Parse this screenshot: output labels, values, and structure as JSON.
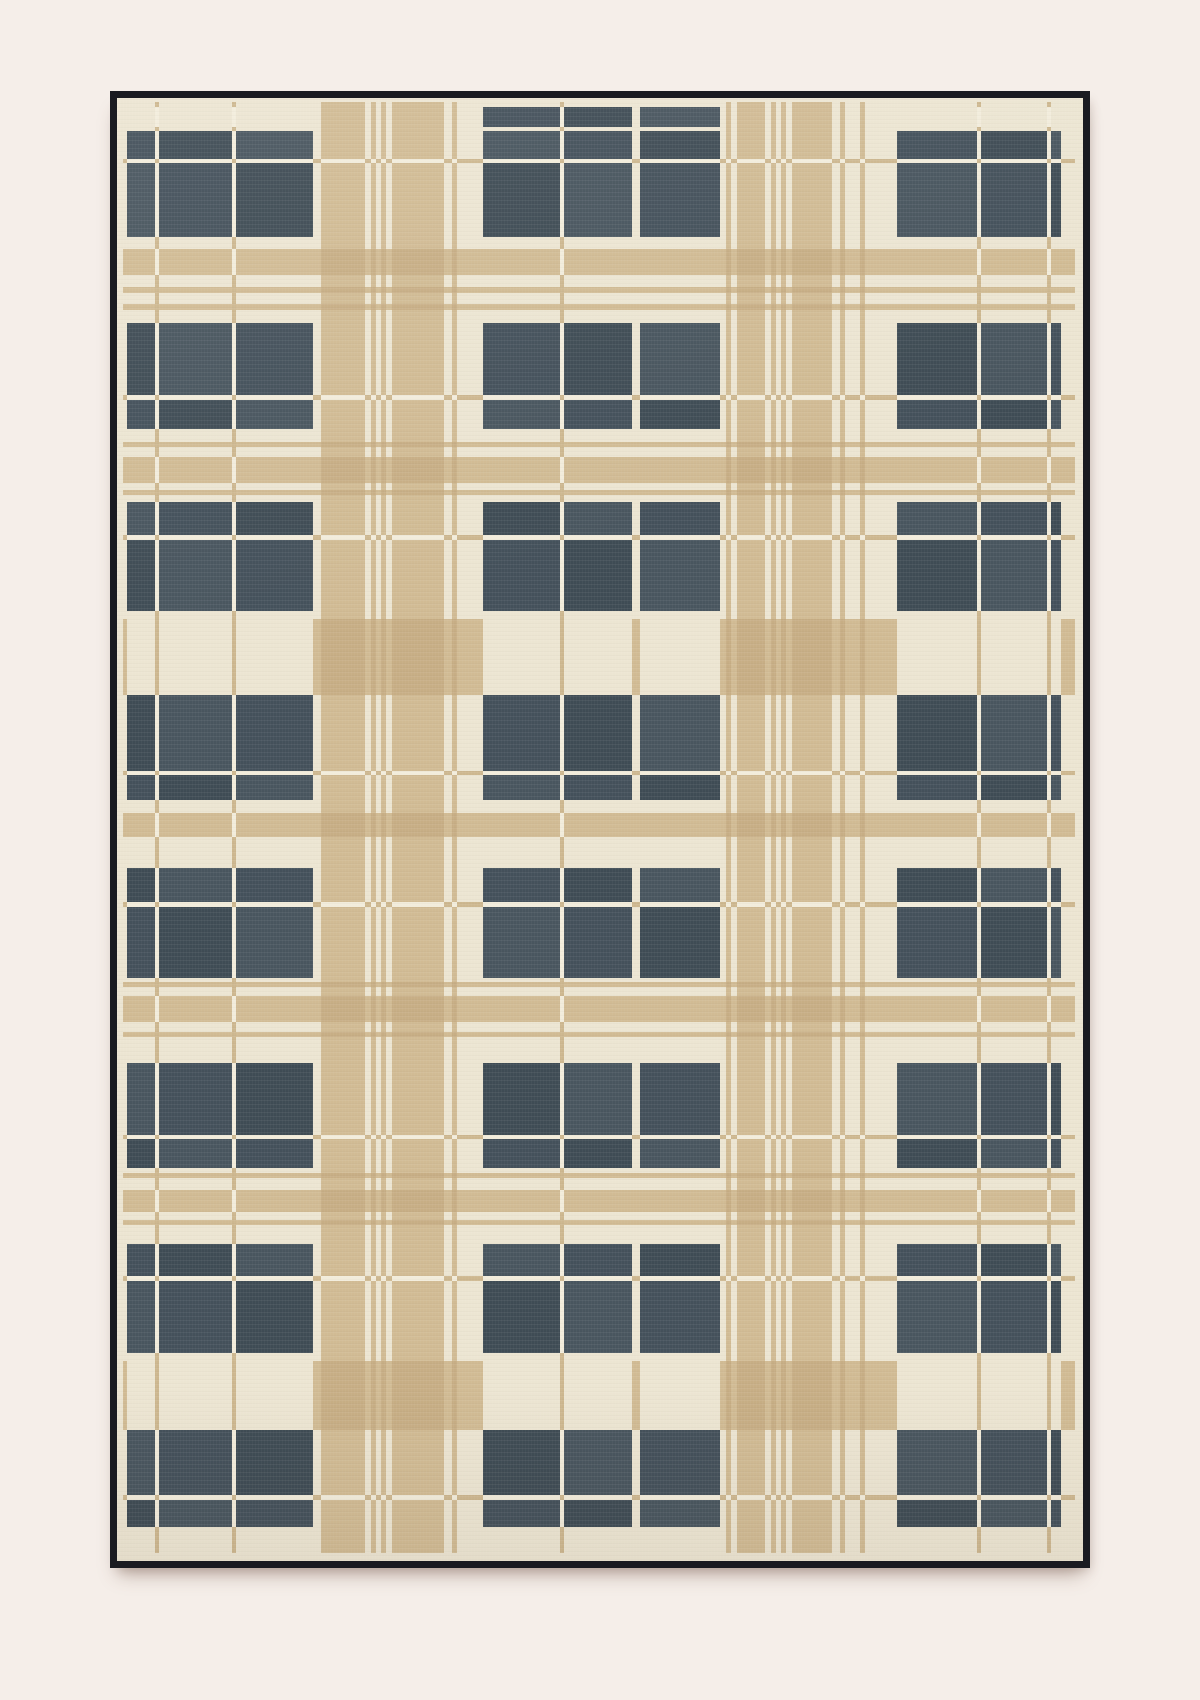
{
  "scene": {
    "type": "product-photograph",
    "subject": "black-framed plaid flatweave rug on pale pink backdrop",
    "background_color": "#f5eee9"
  },
  "frame": {
    "color": "#1a1b21",
    "selvedge_color": "#ece5d2"
  },
  "palette": {
    "background": "#f5eee9",
    "frame": "#1a1b21",
    "dark": "#44515b",
    "darkVariants": [
      "#3f4c55",
      "#44515b",
      "#49565f"
    ],
    "tan": "#d1bb94",
    "tanDeep": "#c7ae85",
    "tanLine": "#cdb78f",
    "cream": "#ece5d2",
    "creamLine": "#f2ecdb"
  },
  "pattern": {
    "legend": {
      "col_types": "W=wide dark-capable warp band, V=wide dark-capable warp band (center group, also dark on D rows), L=thin cream dividing line, C=cream ground, T=medium tan stripe, t=thin tan stripe",
      "row_types": "W=wide dark-capable weft band, D=thin dark weft (center group only), L=thin cream dividing line, C=cream ground, T=medium tan stripe, t=thin tan stripe, B=wide tan band (cream where it crosses dark-capable warps)"
    },
    "cols": [
      [
        "C",
        4
      ],
      [
        "W",
        28
      ],
      [
        "L",
        4
      ],
      [
        "W",
        73
      ],
      [
        "L",
        4
      ],
      [
        "W",
        77
      ],
      [
        "C",
        8
      ],
      [
        "T",
        44
      ],
      [
        "C",
        6
      ],
      [
        "t",
        5
      ],
      [
        "C",
        5
      ],
      [
        "t",
        5
      ],
      [
        "C",
        6
      ],
      [
        "T",
        52
      ],
      [
        "C",
        8
      ],
      [
        "t",
        5
      ],
      [
        "C",
        26
      ],
      [
        "V",
        77
      ],
      [
        "L",
        4
      ],
      [
        "V",
        68
      ],
      [
        "C",
        8
      ],
      [
        "V",
        80
      ],
      [
        "C",
        6
      ],
      [
        "t",
        5
      ],
      [
        "C",
        6
      ],
      [
        "T",
        28
      ],
      [
        "C",
        6
      ],
      [
        "t",
        5
      ],
      [
        "C",
        5
      ],
      [
        "t",
        5
      ],
      [
        "C",
        6
      ],
      [
        "T",
        40
      ],
      [
        "C",
        8
      ],
      [
        "t",
        5
      ],
      [
        "C",
        15
      ],
      [
        "t",
        5
      ],
      [
        "C",
        32
      ],
      [
        "W",
        80
      ],
      [
        "L",
        4
      ],
      [
        "W",
        66
      ],
      [
        "L",
        4
      ],
      [
        "W",
        10
      ],
      [
        "C",
        14
      ]
    ],
    "rows": [
      [
        "C",
        5
      ],
      [
        "D",
        20
      ],
      [
        "C",
        4
      ],
      [
        "W",
        28
      ],
      [
        "L",
        4
      ],
      [
        "W",
        74
      ],
      [
        "C",
        12
      ],
      [
        "T",
        26
      ],
      [
        "C",
        12
      ],
      [
        "t",
        6
      ],
      [
        "C",
        11
      ],
      [
        "t",
        6
      ],
      [
        "C",
        13
      ],
      [
        "W",
        72
      ],
      [
        "L",
        5
      ],
      [
        "W",
        29
      ],
      [
        "C",
        13
      ],
      [
        "t",
        5
      ],
      [
        "C",
        10
      ],
      [
        "T",
        26
      ],
      [
        "C",
        7
      ],
      [
        "t",
        5
      ],
      [
        "C",
        7
      ],
      [
        "W",
        33
      ],
      [
        "L",
        5
      ],
      [
        "W",
        71
      ],
      [
        "C",
        8
      ],
      [
        "B",
        76
      ],
      [
        "W",
        76
      ],
      [
        "L",
        4
      ],
      [
        "W",
        25
      ],
      [
        "C",
        13
      ],
      [
        "T",
        24
      ],
      [
        "C",
        31
      ],
      [
        "W",
        34
      ],
      [
        "L",
        5
      ],
      [
        "W",
        71
      ],
      [
        "C",
        4
      ],
      [
        "t",
        5
      ],
      [
        "C",
        9
      ],
      [
        "T",
        26
      ],
      [
        "C",
        10
      ],
      [
        "t",
        5
      ],
      [
        "C",
        26
      ],
      [
        "W",
        72
      ],
      [
        "L",
        4
      ],
      [
        "W",
        29
      ],
      [
        "C",
        5
      ],
      [
        "t",
        5
      ],
      [
        "C",
        12
      ],
      [
        "T",
        22
      ],
      [
        "C",
        8
      ],
      [
        "t",
        5
      ],
      [
        "C",
        19
      ],
      [
        "W",
        32
      ],
      [
        "L",
        5
      ],
      [
        "W",
        72
      ],
      [
        "C",
        8
      ],
      [
        "B",
        69
      ],
      [
        "W",
        65
      ],
      [
        "L",
        5
      ],
      [
        "W",
        27
      ],
      [
        "C",
        26
      ]
    ],
    "rules": {
      "W|W": "dark",
      "W|D": "cream",
      "W|L": "creamLine",
      "W|C": "cream",
      "W|T": "tan",
      "W|t": "tan",
      "W|B": "cream",
      "V|W": "dark",
      "V|D": "dark",
      "V|L": "creamLine",
      "V|C": "cream",
      "V|T": "tan",
      "V|t": "tan",
      "V|B": "cream",
      "L|W": "creamLine",
      "L|D": "creamLine",
      "L|L": "tanLine",
      "L|C": "tanLine",
      "L|T": "creamLine",
      "L|t": "tanLine",
      "L|B": "tanLine",
      "C|W": "cream",
      "C|D": "cream",
      "C|L": "tanLine",
      "C|C": "cream",
      "C|T": "tan",
      "C|t": "tan",
      "C|B": "tan",
      "T|W": "tan",
      "T|D": "tan",
      "T|L": "creamLine",
      "T|C": "tan",
      "T|T": "tanDeep",
      "T|t": "tanDeep",
      "T|B": "tanDeep",
      "t|W": "tan",
      "t|D": "tan",
      "t|L": "creamLine",
      "t|C": "tan",
      "t|T": "tanDeep",
      "t|t": "tanDeep",
      "t|B": "tanDeep"
    }
  }
}
